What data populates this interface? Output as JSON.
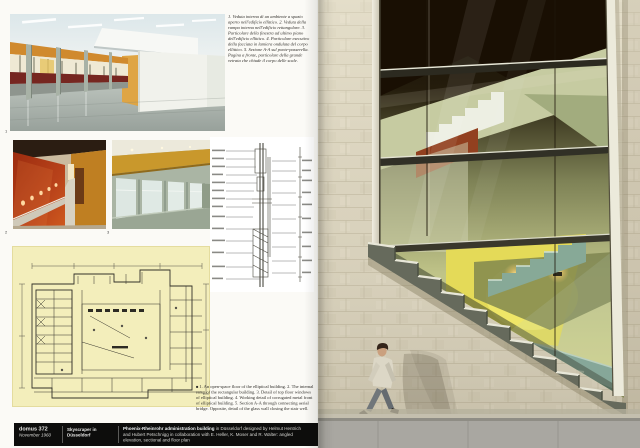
{
  "magazine": {
    "issue": "domus 372",
    "date": "November 1960",
    "article_title": "Skyscraper in Düsseldorf"
  },
  "footer": {
    "issue": "domus 372",
    "date": "November 1960",
    "article_title": "Skyscraper in Düsseldorf",
    "credit_bold": "Phoenix-Rheinrohr administration building",
    "credit_line1_rest": " in Düsseldorf designed by Helmut Hentrich",
    "credit_line2": "and Hubert Petschnigg in collaboration with E. Heller, K. Moser and R. Walter: angled",
    "credit_line3": "elevation, sectional and floor plan"
  },
  "captions": {
    "italian": "1. Veduta interna di un ambiente a spazio aperto nell'edificio ellittico. 2. Veduta della rampa interna nell'edificio rettangolare. 3. Particolare della finestra ad ultimo piano dell'edificio ellittico. 4. Particolare esecutivo della facciata in lamiera ondulata del corpo ellittico. 5. Sezione A-A sul ponte-passerella. Pagina a fronte, particolare della grande vetrata che chiude il corpo delle scale.",
    "english_marker": "■",
    "english": "1. An open-space floor of the elliptical building. 2. The internal ramp of the rectangular building. 3. Detail of top floor windows of elliptical building. 4. Working detail of corrugated metal front of elliptical building. 5. Section A-A through connecting aerial bridge. Opposite, detail of the glass wall closing the stair well."
  },
  "figures": [
    "1",
    "2",
    "3",
    "4"
  ],
  "colors": {
    "stone": "#d8d1bc",
    "glass_dark": "#190f03",
    "sage": "#c6cba1",
    "bright_yellow": "#e4da58",
    "teal_stair": "#7da092",
    "red_wall": "#a63214",
    "ochre_wall": "#dfa544",
    "plan_paper": "#f3eebb",
    "footer_bg": "#0d0d0c"
  }
}
